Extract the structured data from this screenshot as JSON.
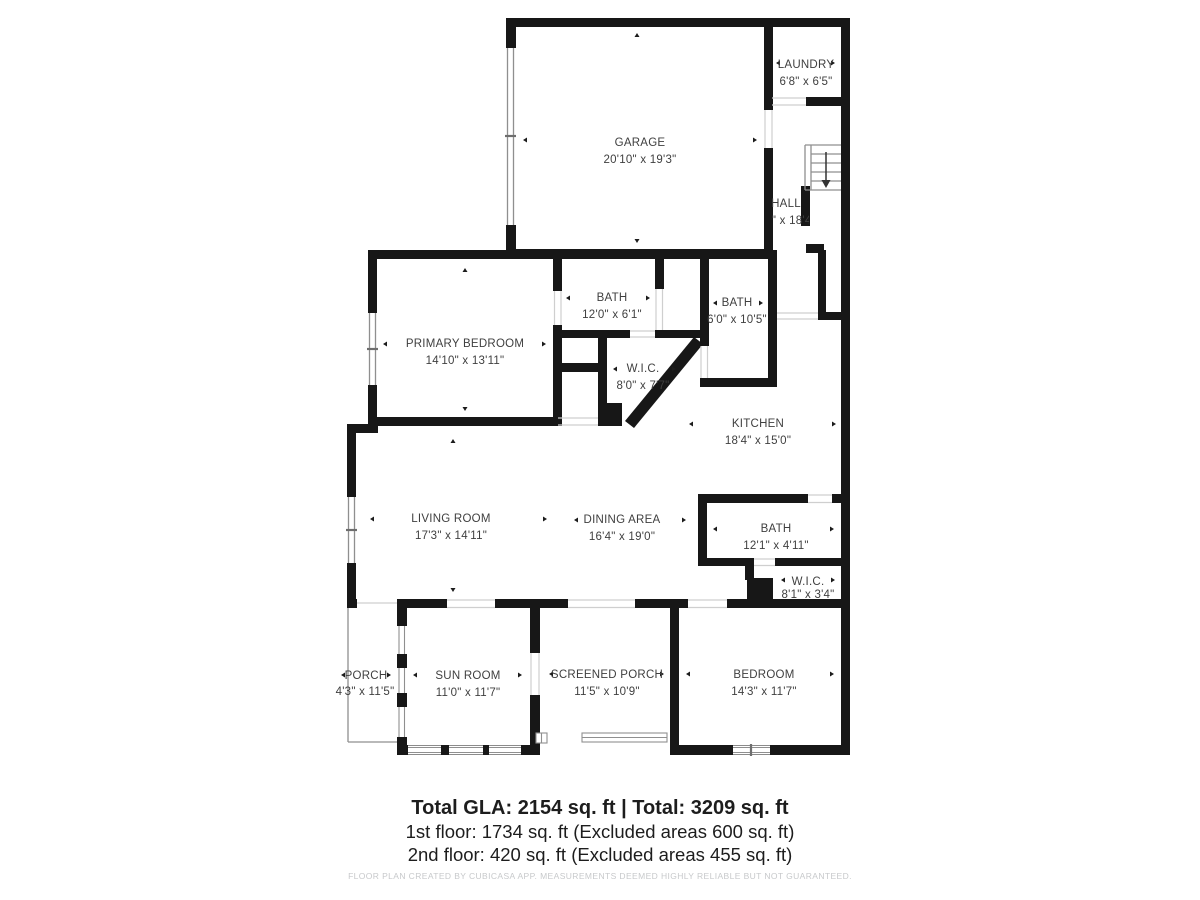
{
  "plan": {
    "rooms": [
      {
        "id": "garage",
        "name": "GARAGE",
        "dims": "20'10\" x 19'3\""
      },
      {
        "id": "laundry",
        "name": "LAUNDRY",
        "dims": "6'8\" x 6'5\""
      },
      {
        "id": "hall",
        "name": "HALL",
        "dims": "6'8\" x 18'4\""
      },
      {
        "id": "bath-upper",
        "name": "BATH",
        "dims": "12'0\" x 6'1\""
      },
      {
        "id": "bath-right",
        "name": "BATH",
        "dims": "6'0\" x 10'5\""
      },
      {
        "id": "primary-bedroom",
        "name": "PRIMARY BEDROOM",
        "dims": "14'10\" x 13'11\""
      },
      {
        "id": "wic-main",
        "name": "W.I.C.",
        "dims": "8'0\" x 7'7\""
      },
      {
        "id": "kitchen",
        "name": "KITCHEN",
        "dims": "18'4\" x 15'0\""
      },
      {
        "id": "living-room",
        "name": "LIVING ROOM",
        "dims": "17'3\" x 14'11\""
      },
      {
        "id": "dining-area",
        "name": "DINING AREA",
        "dims": "16'4\" x 19'0\""
      },
      {
        "id": "bath-lower",
        "name": "BATH",
        "dims": "12'1\" x 4'11\""
      },
      {
        "id": "wic-small",
        "name": "W.I.C.",
        "dims": "8'1\" x 3'4\""
      },
      {
        "id": "porch",
        "name": "PORCH",
        "dims": "4'3\" x 11'5\""
      },
      {
        "id": "sun-room",
        "name": "SUN ROOM",
        "dims": "11'0\" x 11'7\""
      },
      {
        "id": "screened-porch",
        "name": "SCREENED PORCH",
        "dims": "11'5\" x 10'9\""
      },
      {
        "id": "bedroom",
        "name": "BEDROOM",
        "dims": "14'3\" x 11'7\""
      }
    ]
  },
  "summary": {
    "total_line": "Total GLA: 2154 sq. ft | Total: 3209 sq. ft",
    "first_floor_line": "1st floor: 1734 sq. ft (Excluded areas 600 sq. ft)",
    "second_floor_line": "2nd floor: 420 sq. ft (Excluded areas 455 sq. ft)"
  },
  "footer": {
    "disclaimer": "FLOOR PLAN CREATED BY CUBICASA APP. MEASUREMENTS DEEMED HIGHLY RELIABLE BUT NOT GUARANTEED."
  },
  "colors": {
    "wall": "#171717",
    "label": "#3f3f3f",
    "thin": "#8f8f8f",
    "door": "#cfcfcf",
    "summary_text": "#1d1d1d",
    "disclaimer": "#c7c9cb"
  }
}
